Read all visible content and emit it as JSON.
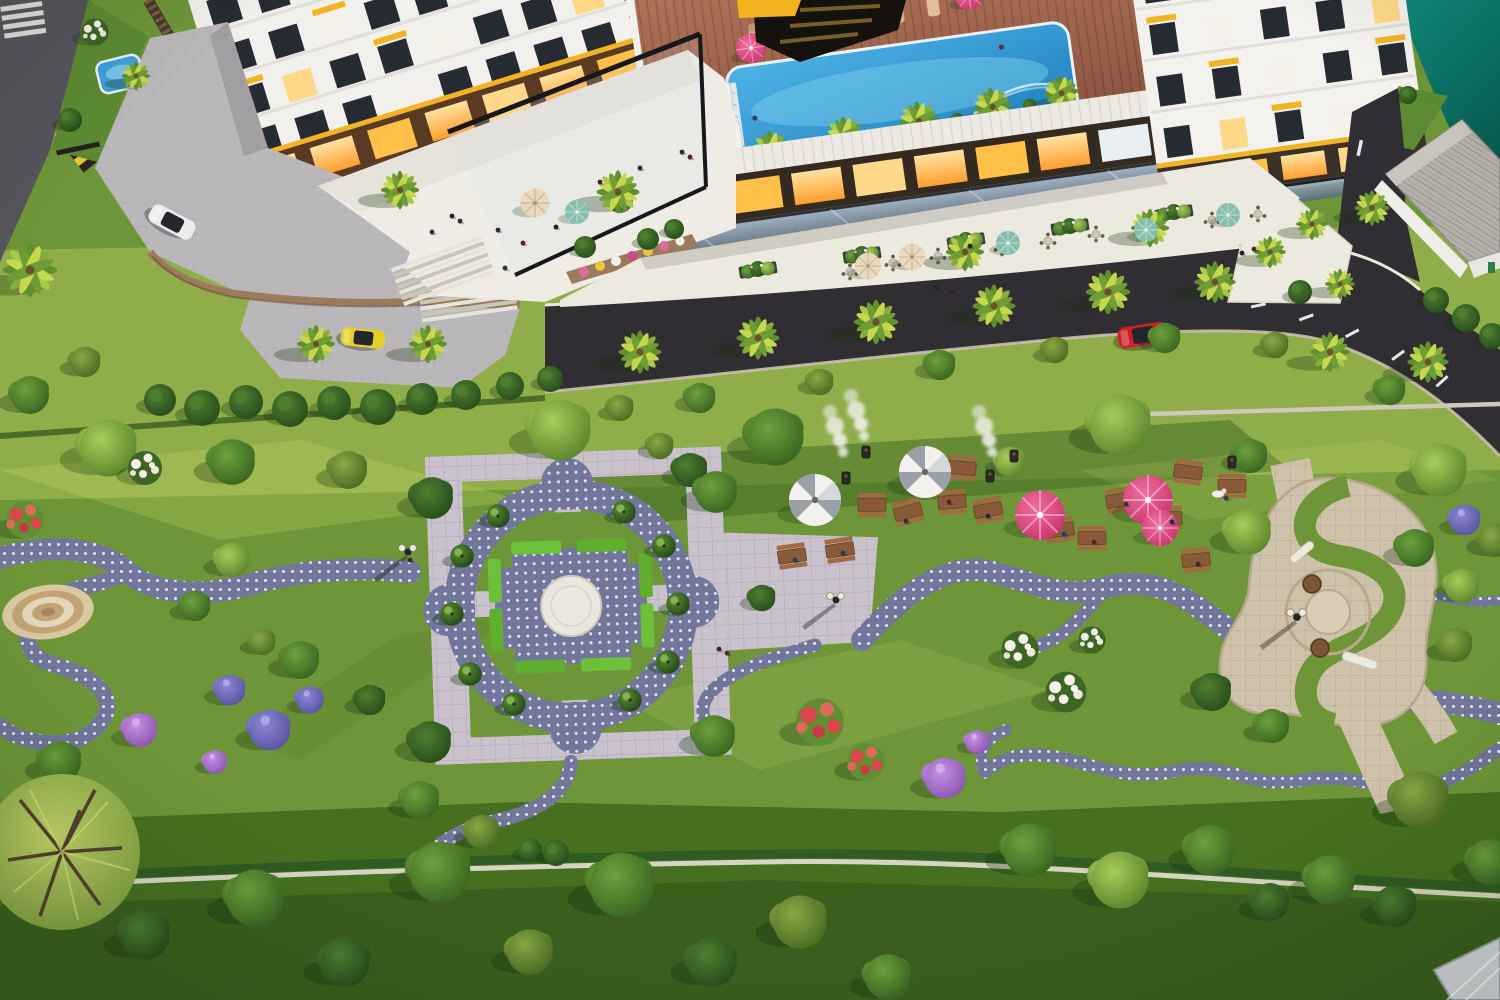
{
  "meta": {
    "description": "Aerial 3D rendering of a residential complex: white towers with yellow window accents, rooftop swimming pool with wooden deck, street cafe promenade along an asphalt road, and a large landscaped park with formal garden plaza, barbecue picnic lawn, spiral plaza, winding dotted footpaths and flowering trees.",
    "width": 1500,
    "height": 1000
  },
  "palette": {
    "grass_base": "#6e9638",
    "grass_light": "#8fae4a",
    "grass_dark": "#46701f",
    "grass_darkest": "#3a5f1d",
    "road": "#302d33",
    "sidewalk": "#eceade",
    "terrace": "#efece6",
    "paver": "#c9c2cc",
    "paver_line": "#b1a9b6",
    "dots_base": "#71769a",
    "dots_white": "#e9ebf4",
    "tan_stone": "#cfc2ab",
    "deck_wood": "#a9674f",
    "pool_blue": "#2f9ad8",
    "pool_light": "#7fd0ee",
    "water_teal": "#0d8276",
    "building_white": "#f4f2ee",
    "window_dark": "#262b33",
    "accent_yellow": "#f3b423",
    "shop_glow": "#ffb945",
    "hedge_green": "#6cc03a",
    "umbrella_pink": "#e14b82",
    "umbrella_stripe": "#9aa0a8",
    "umbrella_cream": "#ead9bc",
    "umbrella_teal": "#87bfae",
    "table_wood": "#8a5a38",
    "stone_wall": "#9c7b5d",
    "fence_brown": "#4a382c",
    "roof_tile": "#b5b0aa",
    "car_red": "#cc2127",
    "car_yellow": "#e6cf2a",
    "car_white": "#ececec",
    "flower_red": "#d9474a",
    "flower_purple": "#a873d6",
    "flower_violet": "#7a74c4",
    "flower_white": "#f4f2e6"
  },
  "areas": [
    "rooftop pool deck",
    "street cafe promenade",
    "entrance terrace",
    "formal garden plaza",
    "barbecue picnic lawn",
    "spiral plaza",
    "great lawn",
    "waterfront corner"
  ],
  "trees": [
    [
      "O",
      620,
      408,
      0.7
    ],
    [
      "M",
      700,
      398,
      0.8
    ],
    [
      "O",
      820,
      382,
      0.7
    ],
    [
      "M",
      940,
      365,
      0.8
    ],
    [
      "O",
      1055,
      350,
      0.7
    ],
    [
      "M",
      1165,
      338,
      0.8
    ],
    [
      "O",
      1275,
      345,
      0.7
    ],
    [
      "M",
      1390,
      390,
      0.8
    ],
    [
      "M",
      30,
      395,
      1
    ],
    [
      "O",
      85,
      362,
      0.8
    ],
    [
      "L",
      108,
      448,
      1.5
    ],
    [
      "M",
      232,
      462,
      1.2
    ],
    [
      "O",
      348,
      470,
      1
    ],
    [
      "L",
      560,
      430,
      1.6
    ],
    [
      "M",
      775,
      437,
      1.5
    ],
    [
      "L",
      1120,
      425,
      1.6
    ],
    [
      "M",
      1250,
      456,
      0.9
    ],
    [
      "L",
      1440,
      470,
      1.4
    ],
    [
      "O",
      1495,
      540,
      0.9
    ],
    [
      "D",
      690,
      470,
      0.9
    ],
    [
      "O",
      660,
      446,
      0.7
    ],
    [
      "L",
      1010,
      462,
      0.8
    ],
    [
      "L",
      1248,
      532,
      1.2
    ],
    [
      "M",
      1415,
      548,
      1
    ],
    [
      "L",
      1462,
      586,
      0.9
    ],
    [
      "D",
      1212,
      692,
      1
    ],
    [
      "M",
      1272,
      726,
      0.9
    ],
    [
      "O",
      1455,
      645,
      0.9
    ],
    [
      "L",
      232,
      560,
      0.9
    ],
    [
      "M",
      300,
      660,
      1
    ],
    [
      "D",
      370,
      700,
      0.8
    ],
    [
      "M",
      195,
      606,
      0.8
    ],
    [
      "O",
      262,
      642,
      0.7
    ],
    [
      "D",
      432,
      498,
      1.1
    ],
    [
      "M",
      716,
      492,
      1.1
    ],
    [
      "D",
      430,
      742,
      1.1
    ],
    [
      "M",
      714,
      736,
      1.1
    ],
    [
      "D",
      762,
      598,
      0.7
    ],
    [
      "M",
      420,
      800,
      1
    ],
    [
      "O",
      482,
      832,
      0.9
    ],
    [
      "M",
      60,
      762,
      1.1
    ],
    [
      "D",
      145,
      935,
      1.3
    ],
    [
      "M",
      255,
      898,
      1.5
    ],
    [
      "D",
      345,
      962,
      1.3
    ],
    [
      "M",
      440,
      872,
      1.6
    ],
    [
      "O",
      530,
      952,
      1.2
    ],
    [
      "M",
      622,
      885,
      1.7
    ],
    [
      "D",
      712,
      962,
      1.3
    ],
    [
      "O",
      800,
      922,
      1.4
    ],
    [
      "M",
      888,
      977,
      1.2
    ],
    [
      "M",
      1030,
      850,
      1.4
    ],
    [
      "L",
      1120,
      880,
      1.5
    ],
    [
      "M",
      1210,
      850,
      1.3
    ],
    [
      "D",
      1270,
      902,
      1
    ],
    [
      "M",
      1330,
      880,
      1.3
    ],
    [
      "D",
      1395,
      906,
      1.1
    ],
    [
      "O",
      1420,
      800,
      1.5
    ],
    [
      "M",
      1490,
      862,
      1.2
    ],
    [
      "R",
      25,
      520,
      1.1
    ],
    [
      "W",
      145,
      468,
      1
    ],
    [
      "P",
      140,
      730,
      1
    ],
    [
      "V",
      230,
      690,
      0.9
    ],
    [
      "V",
      270,
      730,
      1.2
    ],
    [
      "V",
      310,
      700,
      0.8
    ],
    [
      "P",
      215,
      762,
      0.7
    ],
    [
      "R",
      820,
      722,
      1.4
    ],
    [
      "R",
      866,
      762,
      1.1
    ],
    [
      "P",
      945,
      778,
      1.2
    ],
    [
      "P",
      977,
      742,
      0.7
    ],
    [
      "W",
      1020,
      650,
      1.1
    ],
    [
      "W",
      1066,
      692,
      1.2
    ],
    [
      "W",
      1092,
      640,
      0.8
    ],
    [
      "V",
      1465,
      520,
      0.9
    ],
    [
      "W",
      95,
      32,
      0.8
    ],
    [
      "C",
      498,
      516,
      0.9
    ],
    [
      "C",
      462,
      556,
      0.9
    ],
    [
      "C",
      452,
      614,
      0.9
    ],
    [
      "C",
      470,
      674,
      0.9
    ],
    [
      "C",
      514,
      704,
      0.9
    ],
    [
      "C",
      630,
      700,
      0.9
    ],
    [
      "C",
      668,
      662,
      0.9
    ],
    [
      "C",
      678,
      604,
      0.9
    ],
    [
      "C",
      664,
      546,
      0.9
    ],
    [
      "C",
      624,
      512,
      0.9
    ]
  ],
  "palms": [
    [
      30,
      270,
      1.7
    ],
    [
      136,
      76,
      0.9
    ],
    [
      316,
      344,
      1.2
    ],
    [
      428,
      344,
      1.2
    ],
    [
      400,
      190,
      1.2
    ],
    [
      618,
      192,
      1.35
    ],
    [
      640,
      352,
      1.35
    ],
    [
      758,
      338,
      1.35
    ],
    [
      876,
      322,
      1.4
    ],
    [
      994,
      306,
      1.35
    ],
    [
      1108,
      292,
      1.4
    ],
    [
      1215,
      282,
      1.3
    ],
    [
      1330,
      352,
      1.25
    ],
    [
      1428,
      362,
      1.3
    ],
    [
      965,
      252,
      1.2
    ],
    [
      1150,
      228,
      1.2
    ],
    [
      1270,
      252,
      1
    ],
    [
      1312,
      224,
      1
    ],
    [
      1340,
      284,
      0.95
    ],
    [
      1372,
      208,
      1.1
    ]
  ],
  "umbrellas": [
    [
      "stripe",
      815,
      500,
      2
    ],
    [
      "stripe",
      925,
      472,
      2
    ],
    [
      "pink",
      1040,
      515,
      1.9
    ],
    [
      "pink",
      1148,
      500,
      1.9
    ],
    [
      "pink",
      1160,
      528,
      1.4
    ],
    [
      "cream",
      868,
      266,
      1.1
    ],
    [
      "cream",
      912,
      257,
      1.1
    ],
    [
      "cream",
      535,
      203,
      1.2
    ],
    [
      "teal",
      577,
      212,
      1
    ],
    [
      "teal",
      1008,
      243,
      1
    ],
    [
      "teal",
      1146,
      230,
      1
    ],
    [
      "teal",
      1228,
      215,
      1
    ]
  ],
  "picnic_tables": [
    [
      792,
      556,
      -8
    ],
    [
      840,
      550,
      -8
    ],
    [
      872,
      505,
      0
    ],
    [
      908,
      512,
      -15
    ],
    [
      952,
      502,
      -5
    ],
    [
      988,
      510,
      -10
    ],
    [
      930,
      470,
      0
    ],
    [
      962,
      468,
      5
    ],
    [
      1060,
      530,
      -8
    ],
    [
      1092,
      538,
      0
    ],
    [
      1120,
      500,
      -10
    ],
    [
      1168,
      518,
      0
    ],
    [
      1196,
      560,
      -6
    ],
    [
      1232,
      486,
      0
    ],
    [
      1188,
      472,
      8
    ]
  ],
  "grills": [
    [
      846,
      478
    ],
    [
      866,
      452
    ],
    [
      990,
      476
    ],
    [
      1014,
      456
    ],
    [
      1232,
      462
    ]
  ],
  "smoke": [
    [
      843,
      452
    ],
    [
      864,
      436
    ],
    [
      992,
      452
    ]
  ],
  "lamps": [
    [
      408,
      552
    ],
    [
      836,
      600
    ]
  ],
  "bushes": [
    [
      160,
      400,
      16
    ],
    [
      202,
      408,
      18
    ],
    [
      246,
      402,
      17
    ],
    [
      290,
      409,
      18
    ],
    [
      334,
      403,
      17
    ],
    [
      378,
      407,
      18
    ],
    [
      422,
      399,
      16
    ],
    [
      466,
      395,
      15
    ],
    [
      510,
      386,
      14
    ],
    [
      550,
      379,
      13
    ],
    [
      1300,
      292,
      12
    ],
    [
      1436,
      300,
      13
    ],
    [
      1466,
      318,
      14
    ],
    [
      1492,
      336,
      13
    ],
    [
      585,
      247,
      11
    ],
    [
      648,
      239,
      11
    ],
    [
      674,
      229,
      10
    ],
    [
      70,
      120,
      12
    ],
    [
      530,
      850,
      12
    ],
    [
      556,
      853,
      13
    ],
    [
      1408,
      95,
      9
    ]
  ],
  "planters": [
    [
      758,
      270,
      -9
    ],
    [
      862,
      255,
      -9
    ],
    [
      966,
      241,
      -9
    ],
    [
      1070,
      227,
      -9
    ],
    [
      1174,
      213,
      -9
    ]
  ],
  "cafe_tables": [
    [
      850,
      272
    ],
    [
      893,
      263
    ],
    [
      938,
      256
    ],
    [
      1002,
      248
    ],
    [
      1048,
      241
    ],
    [
      1096,
      234
    ],
    [
      1212,
      220
    ],
    [
      1258,
      214
    ]
  ],
  "cars": [
    [
      "#ececec",
      172,
      222,
      28,
      1
    ],
    [
      "#e6cf2a",
      363,
      338,
      6,
      0.92
    ],
    [
      "#cc2127",
      1143,
      335,
      -9,
      1.05
    ]
  ],
  "people": [
    [
      452,
      216,
      "#1d2430"
    ],
    [
      460,
      221,
      "#432530"
    ],
    [
      498,
      230,
      "#20303f"
    ],
    [
      523,
      243,
      "#5a2020"
    ],
    [
      556,
      227,
      "#1d2430"
    ],
    [
      600,
      182,
      "#33261e"
    ],
    [
      640,
      168,
      "#1d2430"
    ],
    [
      682,
      152,
      "#20303f"
    ],
    [
      690,
      157,
      "#5a2020"
    ],
    [
      432,
      232,
      "#263043"
    ],
    [
      505,
      268,
      "#2a3342"
    ],
    [
      936,
      287,
      "#20293a"
    ],
    [
      950,
      291,
      "#39232a"
    ],
    [
      1242,
      253,
      "#1d2430"
    ],
    [
      1254,
      249,
      "#4a2a22"
    ],
    [
      970,
      246,
      "#23262e"
    ],
    [
      906,
      521,
      "#24304a"
    ],
    [
      949,
      502,
      "#55241e"
    ],
    [
      988,
      516,
      "#222b38"
    ],
    [
      795,
      560,
      "#24425c"
    ],
    [
      843,
      553,
      "#33383f"
    ],
    [
      1064,
      534,
      "#23415a"
    ],
    [
      1094,
      542,
      "#55262c"
    ],
    [
      1126,
      504,
      "#243447"
    ],
    [
      1172,
      522,
      "#1b3050"
    ],
    [
      1198,
      564,
      "#33302c"
    ],
    [
      719,
      649,
      "#222f3c"
    ],
    [
      727,
      653,
      "#53302c"
    ],
    [
      410,
      560,
      "#27313f"
    ],
    [
      1226,
      498,
      "#34404e"
    ]
  ]
}
